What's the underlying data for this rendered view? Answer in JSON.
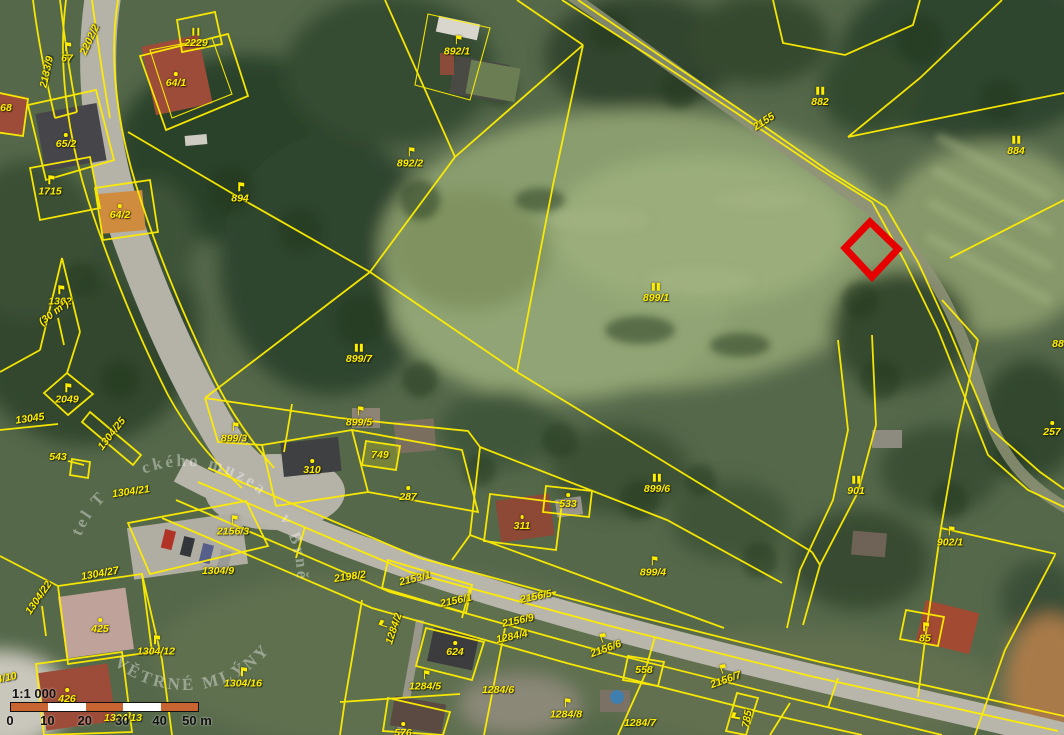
{
  "map": {
    "type": "cadastral-parcel-map-over-aerial-photo",
    "colors": {
      "parcel_line": "#ffee00",
      "highlight": "#e60000",
      "label_text": "#ffee00",
      "scale_orange": "#c86432",
      "scale_white": "#ffffff"
    },
    "highlight_parcel": {
      "points": "870,222 898,249 872,277 845,248"
    },
    "labels": [
      {
        "t": "2202/2",
        "x": 90,
        "y": 40,
        "r": -65
      },
      {
        "t": "2133/9",
        "x": 47,
        "y": 72,
        "r": -78
      },
      {
        "t": "67",
        "x": 67,
        "y": 53,
        "s": "flag"
      },
      {
        "t": "2229",
        "x": 196,
        "y": 38,
        "s": "bars"
      },
      {
        "t": "64/1",
        "x": 176,
        "y": 80,
        "s": "dot"
      },
      {
        "t": "68",
        "x": 6,
        "y": 108
      },
      {
        "t": "65/2",
        "x": 66,
        "y": 141,
        "s": "dot"
      },
      {
        "t": "1715",
        "x": 50,
        "y": 186,
        "s": "flag"
      },
      {
        "t": "64/2",
        "x": 120,
        "y": 212,
        "s": "dot"
      },
      {
        "t": "894",
        "x": 240,
        "y": 193,
        "s": "flag"
      },
      {
        "t": "892/1",
        "x": 457,
        "y": 46,
        "s": "flag"
      },
      {
        "t": "892/2",
        "x": 410,
        "y": 158,
        "s": "flag"
      },
      {
        "t": "2155",
        "x": 764,
        "y": 122,
        "r": -33
      },
      {
        "t": "882",
        "x": 820,
        "y": 97,
        "s": "bars"
      },
      {
        "t": "884",
        "x": 1016,
        "y": 146,
        "s": "bars"
      },
      {
        "t": "88",
        "x": 1058,
        "y": 344
      },
      {
        "t": "899/1",
        "x": 656,
        "y": 293,
        "s": "bars"
      },
      {
        "t": "899/7",
        "x": 359,
        "y": 354,
        "s": "bars"
      },
      {
        "t": "1302",
        "x": 60,
        "y": 296,
        "s": "flag"
      },
      {
        "t": "(30 m²)",
        "x": 54,
        "y": 313,
        "r": -38
      },
      {
        "t": "2049",
        "x": 67,
        "y": 394,
        "s": "flag"
      },
      {
        "t": "13045",
        "x": 30,
        "y": 419,
        "r": -8
      },
      {
        "t": "1304/25",
        "x": 112,
        "y": 434,
        "r": -52
      },
      {
        "t": "543",
        "x": 58,
        "y": 457
      },
      {
        "t": "899/3",
        "x": 234,
        "y": 433,
        "s": "flag"
      },
      {
        "t": "899/5",
        "x": 359,
        "y": 417,
        "s": "flag"
      },
      {
        "t": "310",
        "x": 312,
        "y": 467,
        "s": "dot"
      },
      {
        "t": "749",
        "x": 380,
        "y": 455
      },
      {
        "t": "287",
        "x": 408,
        "y": 494,
        "s": "dot"
      },
      {
        "t": "899/6",
        "x": 657,
        "y": 484,
        "s": "bars"
      },
      {
        "t": "533",
        "x": 568,
        "y": 501,
        "s": "dot"
      },
      {
        "t": "311",
        "x": 522,
        "y": 523,
        "s": "dot"
      },
      {
        "t": "899/4",
        "x": 653,
        "y": 567,
        "s": "flag"
      },
      {
        "t": "901",
        "x": 856,
        "y": 486,
        "s": "bars"
      },
      {
        "t": "902/1",
        "x": 950,
        "y": 537,
        "s": "flag"
      },
      {
        "t": "257",
        "x": 1052,
        "y": 429,
        "s": "dot"
      },
      {
        "t": "2156/3",
        "x": 233,
        "y": 526,
        "s": "flag"
      },
      {
        "t": "1304/21",
        "x": 131,
        "y": 492,
        "r": -8
      },
      {
        "t": "1304/27",
        "x": 100,
        "y": 574,
        "r": -10
      },
      {
        "t": "1304/9",
        "x": 218,
        "y": 571
      },
      {
        "t": "1304/22",
        "x": 39,
        "y": 598,
        "r": -55
      },
      {
        "t": "425",
        "x": 100,
        "y": 626,
        "s": "dot"
      },
      {
        "t": "1304/12",
        "x": 156,
        "y": 646,
        "s": "flag"
      },
      {
        "t": "1304/10",
        "x": -2,
        "y": 680,
        "r": -12
      },
      {
        "t": "426",
        "x": 67,
        "y": 696,
        "s": "dot"
      },
      {
        "t": "1304/13",
        "x": 123,
        "y": 718
      },
      {
        "t": "1304/16",
        "x": 243,
        "y": 678,
        "s": "flag"
      },
      {
        "t": "2198/2",
        "x": 350,
        "y": 577,
        "r": -8
      },
      {
        "t": "2153/1",
        "x": 415,
        "y": 579,
        "r": -14
      },
      {
        "t": "2156/1",
        "x": 456,
        "y": 601,
        "r": -12
      },
      {
        "t": "2156/5",
        "x": 536,
        "y": 597,
        "r": -12
      },
      {
        "t": "2156/9",
        "x": 518,
        "y": 621,
        "r": -12
      },
      {
        "t": "1284/4",
        "x": 512,
        "y": 637,
        "r": -12
      },
      {
        "t": "2156/6",
        "x": 604,
        "y": 644,
        "r": -20,
        "s": "flag"
      },
      {
        "t": "1284/2",
        "x": 389,
        "y": 627,
        "r": -72,
        "s": "flag"
      },
      {
        "t": "624",
        "x": 455,
        "y": 649,
        "s": "dot"
      },
      {
        "t": "1284/5",
        "x": 425,
        "y": 681,
        "s": "flag"
      },
      {
        "t": "1284/6",
        "x": 498,
        "y": 690
      },
      {
        "t": "1284/8",
        "x": 566,
        "y": 709,
        "s": "flag"
      },
      {
        "t": "1284/7",
        "x": 640,
        "y": 723
      },
      {
        "t": "558",
        "x": 644,
        "y": 670
      },
      {
        "t": "2156/7",
        "x": 724,
        "y": 675,
        "r": -20,
        "s": "flag"
      },
      {
        "t": "785",
        "x": 742,
        "y": 718,
        "r": -80,
        "s": "flag"
      },
      {
        "t": "85",
        "x": 925,
        "y": 633,
        "s": "flag"
      },
      {
        "t": "576",
        "x": 403,
        "y": 730,
        "s": "dot"
      }
    ],
    "scale_bar": {
      "ratio": "1:1 000",
      "ticks": [
        "0",
        "10",
        "20",
        "30",
        "40",
        "50 m"
      ],
      "segments": [
        "#c86432",
        "#ffffff",
        "#c86432",
        "#ffffff",
        "#c86432"
      ]
    },
    "watermark": {
      "arc_top": "ckého muzea",
      "arc_right": "v Brně",
      "arc_bottom": "VĚTRNÉ MLÝNY",
      "arc_left": "tel T"
    }
  }
}
